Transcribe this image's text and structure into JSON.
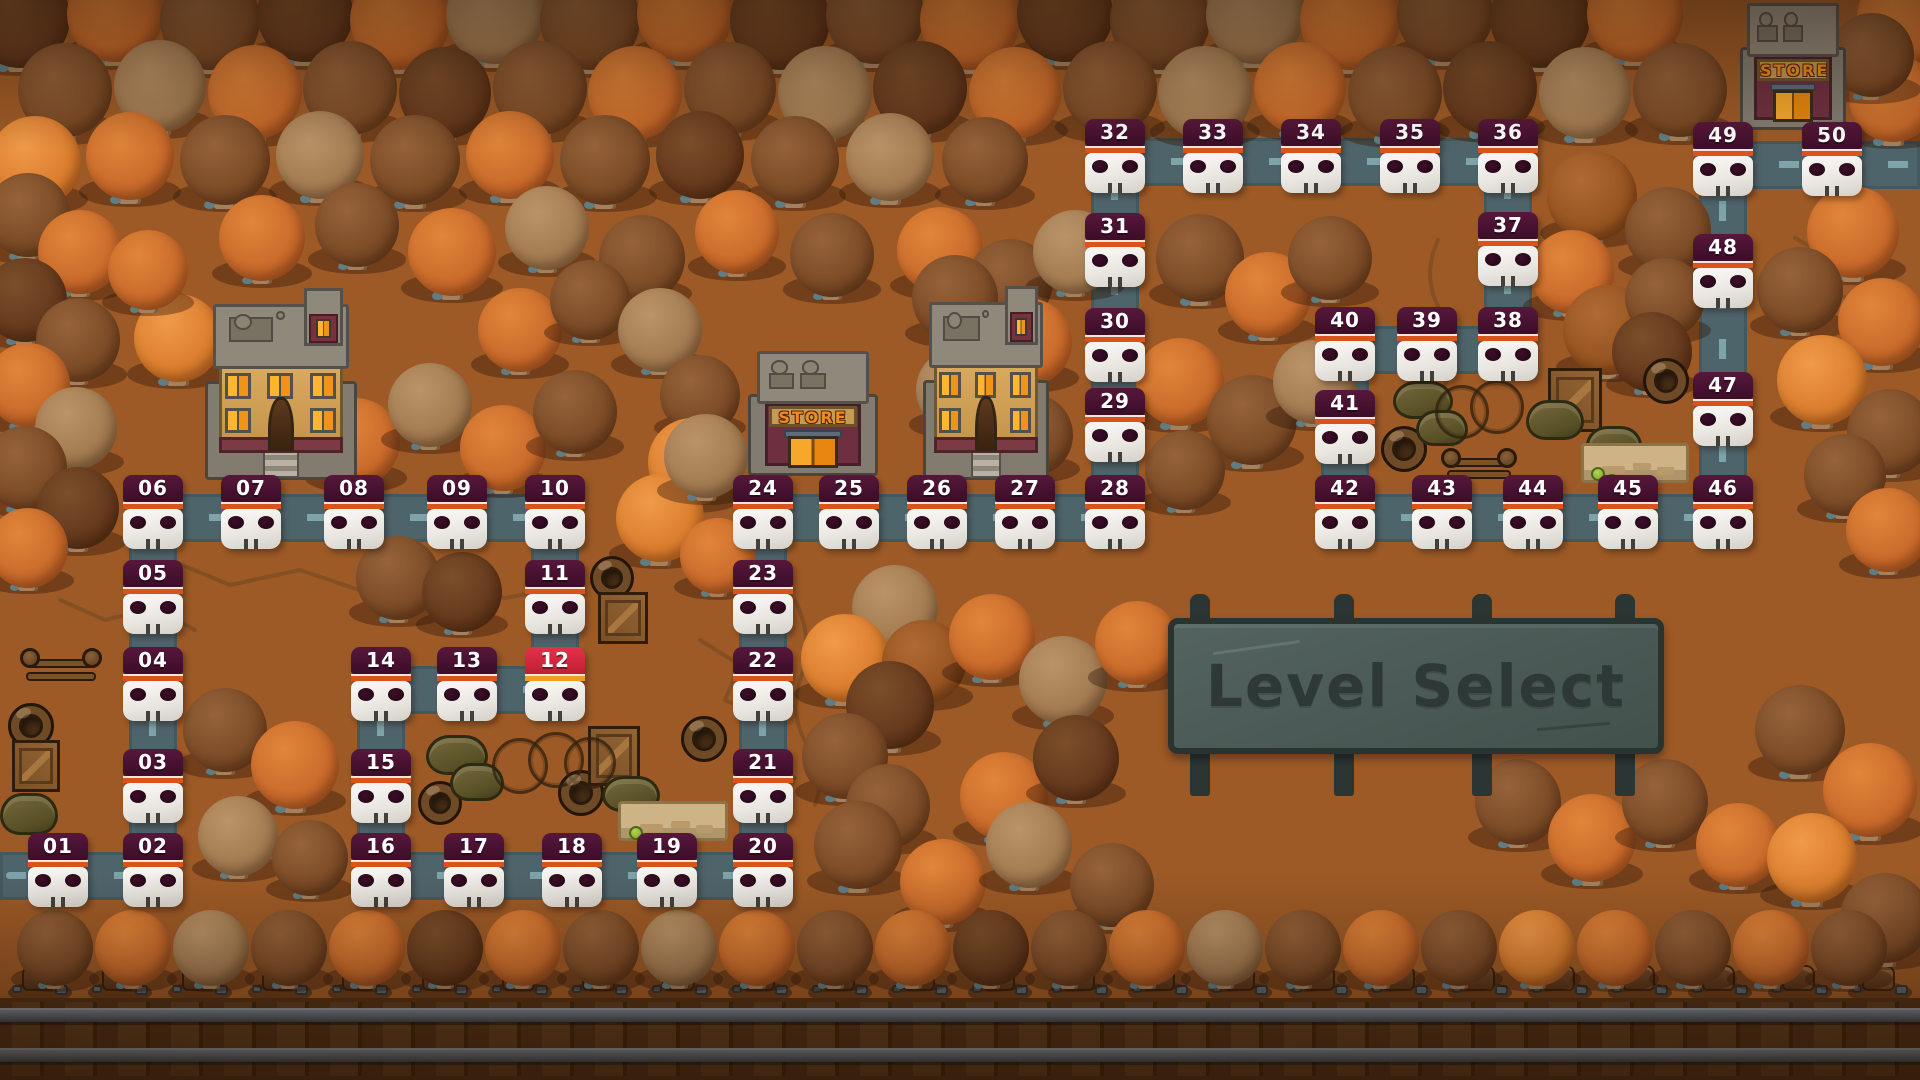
{
  "title": "Level Select",
  "sign": {
    "label": "Level Select"
  },
  "current_level": "12",
  "colors": {
    "ground": "#a05c27",
    "road": "#4e646b",
    "road_dash": "#86aeb3",
    "banner": "#451130",
    "banner_current": "#d32a3c",
    "stripe": "#d9531d",
    "stripe_current": "#eca01d",
    "skull": "#ece9e4",
    "sign_board": "#4a5955",
    "sign_text": "#2e3836"
  },
  "levels": [
    {
      "id": "01",
      "x": 58,
      "y": 876
    },
    {
      "id": "02",
      "x": 153,
      "y": 876
    },
    {
      "id": "03",
      "x": 153,
      "y": 792
    },
    {
      "id": "04",
      "x": 153,
      "y": 690
    },
    {
      "id": "05",
      "x": 153,
      "y": 603
    },
    {
      "id": "06",
      "x": 153,
      "y": 518
    },
    {
      "id": "07",
      "x": 251,
      "y": 518
    },
    {
      "id": "08",
      "x": 354,
      "y": 518
    },
    {
      "id": "09",
      "x": 457,
      "y": 518
    },
    {
      "id": "10",
      "x": 555,
      "y": 518
    },
    {
      "id": "11",
      "x": 555,
      "y": 603
    },
    {
      "id": "12",
      "x": 555,
      "y": 690,
      "state": "current"
    },
    {
      "id": "13",
      "x": 467,
      "y": 690
    },
    {
      "id": "14",
      "x": 381,
      "y": 690
    },
    {
      "id": "15",
      "x": 381,
      "y": 792
    },
    {
      "id": "16",
      "x": 381,
      "y": 876
    },
    {
      "id": "17",
      "x": 474,
      "y": 876
    },
    {
      "id": "18",
      "x": 572,
      "y": 876
    },
    {
      "id": "19",
      "x": 667,
      "y": 876
    },
    {
      "id": "20",
      "x": 763,
      "y": 876
    },
    {
      "id": "21",
      "x": 763,
      "y": 792
    },
    {
      "id": "22",
      "x": 763,
      "y": 690
    },
    {
      "id": "23",
      "x": 763,
      "y": 603
    },
    {
      "id": "24",
      "x": 763,
      "y": 518
    },
    {
      "id": "25",
      "x": 849,
      "y": 518
    },
    {
      "id": "26",
      "x": 937,
      "y": 518
    },
    {
      "id": "27",
      "x": 1025,
      "y": 518
    },
    {
      "id": "28",
      "x": 1115,
      "y": 518
    },
    {
      "id": "29",
      "x": 1115,
      "y": 431
    },
    {
      "id": "30",
      "x": 1115,
      "y": 351
    },
    {
      "id": "31",
      "x": 1115,
      "y": 256
    },
    {
      "id": "32",
      "x": 1115,
      "y": 162
    },
    {
      "id": "33",
      "x": 1213,
      "y": 162
    },
    {
      "id": "34",
      "x": 1311,
      "y": 162
    },
    {
      "id": "35",
      "x": 1410,
      "y": 162
    },
    {
      "id": "36",
      "x": 1508,
      "y": 162
    },
    {
      "id": "37",
      "x": 1508,
      "y": 255
    },
    {
      "id": "38",
      "x": 1508,
      "y": 350
    },
    {
      "id": "39",
      "x": 1427,
      "y": 350
    },
    {
      "id": "40",
      "x": 1345,
      "y": 350
    },
    {
      "id": "41",
      "x": 1345,
      "y": 433
    },
    {
      "id": "42",
      "x": 1345,
      "y": 518
    },
    {
      "id": "43",
      "x": 1442,
      "y": 518
    },
    {
      "id": "44",
      "x": 1533,
      "y": 518
    },
    {
      "id": "45",
      "x": 1628,
      "y": 518
    },
    {
      "id": "46",
      "x": 1723,
      "y": 518
    },
    {
      "id": "47",
      "x": 1723,
      "y": 415
    },
    {
      "id": "48",
      "x": 1723,
      "y": 277
    },
    {
      "id": "49",
      "x": 1723,
      "y": 165
    },
    {
      "id": "50",
      "x": 1832,
      "y": 165
    }
  ],
  "path": {
    "road_width": 48,
    "extra_segments": [
      [
        0,
        876,
        58,
        876
      ],
      [
        1832,
        165,
        1920,
        165
      ]
    ]
  },
  "buildings": [
    {
      "type": "house",
      "x": 205,
      "y": 288,
      "w": 152,
      "h": 194
    },
    {
      "type": "store",
      "label": "STORE",
      "x": 748,
      "y": 348,
      "w": 130,
      "h": 128
    },
    {
      "type": "house",
      "x": 923,
      "y": 286,
      "w": 126,
      "h": 196
    },
    {
      "type": "store",
      "label": "STORE",
      "x": 1740,
      "y": 0,
      "w": 106,
      "h": 130
    }
  ],
  "decorations": {
    "fences": [
      {
        "x": 20,
        "y": 648,
        "w": 82,
        "h": 38
      },
      {
        "x": 1441,
        "y": 448,
        "w": 76,
        "h": 36
      }
    ],
    "barrels": [
      [
        8,
        703,
        46
      ],
      [
        418,
        781,
        44
      ],
      [
        558,
        770,
        46
      ],
      [
        681,
        716,
        46
      ],
      [
        1381,
        426,
        46
      ],
      [
        1643,
        358,
        46
      ],
      [
        590,
        556,
        44
      ]
    ],
    "crates": [
      [
        12,
        740,
        48,
        52
      ],
      [
        598,
        592,
        50,
        52
      ],
      [
        588,
        726,
        52,
        60
      ],
      [
        1548,
        368,
        54,
        64
      ]
    ],
    "sandbags": [
      [
        0,
        793,
        58,
        42
      ],
      [
        426,
        735,
        62,
        40
      ],
      [
        450,
        763,
        54,
        38
      ],
      [
        602,
        776,
        58,
        36
      ],
      [
        1393,
        381,
        60,
        38
      ],
      [
        1416,
        410,
        52,
        36
      ],
      [
        1526,
        400,
        58,
        40
      ],
      [
        1586,
        426,
        56,
        36
      ]
    ],
    "wires": [
      [
        520,
        766,
        28
      ],
      [
        556,
        760,
        28
      ],
      [
        590,
        763,
        26
      ],
      [
        1462,
        412,
        27
      ],
      [
        1497,
        407,
        27
      ]
    ],
    "planks": [
      [
        618,
        801,
        110,
        40
      ],
      [
        1581,
        443,
        108,
        40
      ]
    ],
    "plants": [
      [
        636,
        833
      ],
      [
        652,
        840
      ],
      [
        1598,
        474
      ],
      [
        1612,
        481
      ]
    ]
  },
  "sign_layout": {
    "board": [
      1168,
      618,
      496,
      136
    ],
    "posts_x": [
      1190,
      1334,
      1472,
      1615
    ],
    "post_top_y": 594,
    "post_top_h": 34,
    "post_bot_y": 748,
    "post_bot_h": 48
  },
  "stumps": {
    "y": 985,
    "xs": [
      40,
      120,
      200,
      280,
      360,
      440,
      520,
      600,
      680,
      760,
      840,
      920,
      1000,
      1080,
      1160,
      1240,
      1320,
      1400,
      1480,
      1560,
      1640,
      1720,
      1800,
      1880
    ]
  },
  "trees": [
    [
      20,
      18,
      50,
      3
    ],
    [
      115,
      14,
      48,
      0
    ],
    [
      210,
      20,
      50,
      1
    ],
    [
      305,
      14,
      48,
      3
    ],
    [
      400,
      20,
      50,
      0
    ],
    [
      495,
      15,
      49,
      2
    ],
    [
      590,
      20,
      50,
      1
    ],
    [
      685,
      14,
      48,
      0
    ],
    [
      780,
      20,
      50,
      3
    ],
    [
      875,
      15,
      49,
      1
    ],
    [
      970,
      20,
      50,
      0
    ],
    [
      1065,
      14,
      48,
      3
    ],
    [
      1160,
      20,
      50,
      1
    ],
    [
      1255,
      15,
      49,
      2
    ],
    [
      1350,
      20,
      50,
      0
    ],
    [
      1445,
      14,
      48,
      1
    ],
    [
      1540,
      18,
      50,
      3
    ],
    [
      1635,
      14,
      48,
      0
    ],
    [
      1905,
      18,
      48,
      0
    ],
    [
      65,
      90,
      47,
      1
    ],
    [
      160,
      86,
      46,
      2
    ],
    [
      255,
      92,
      47,
      0
    ],
    [
      350,
      88,
      47,
      1
    ],
    [
      445,
      93,
      46,
      3
    ],
    [
      540,
      88,
      47,
      1
    ],
    [
      635,
      93,
      47,
      0
    ],
    [
      730,
      88,
      46,
      1
    ],
    [
      825,
      93,
      47,
      2
    ],
    [
      920,
      88,
      47,
      3
    ],
    [
      1015,
      93,
      46,
      0
    ],
    [
      1110,
      88,
      47,
      1
    ],
    [
      1205,
      93,
      47,
      2
    ],
    [
      1300,
      88,
      46,
      0
    ],
    [
      1395,
      93,
      47,
      1
    ],
    [
      1490,
      88,
      47,
      3
    ],
    [
      1585,
      93,
      46,
      2
    ],
    [
      1680,
      90,
      47,
      1
    ],
    [
      1893,
      98,
      44,
      0
    ],
    [
      1872,
      55,
      42,
      1
    ],
    [
      35,
      162,
      46,
      5
    ],
    [
      130,
      156,
      44,
      0
    ],
    [
      225,
      160,
      45,
      1
    ],
    [
      320,
      155,
      44,
      2
    ],
    [
      415,
      160,
      45,
      1
    ],
    [
      510,
      155,
      44,
      0
    ],
    [
      605,
      160,
      45,
      1
    ],
    [
      700,
      155,
      44,
      3
    ],
    [
      795,
      160,
      44,
      1
    ],
    [
      890,
      157,
      44,
      2
    ],
    [
      985,
      160,
      43,
      1
    ],
    [
      28,
      215,
      42,
      1
    ],
    [
      80,
      252,
      42,
      0
    ],
    [
      25,
      300,
      42,
      3
    ],
    [
      78,
      340,
      42,
      1
    ],
    [
      28,
      385,
      42,
      0
    ],
    [
      76,
      428,
      41,
      2
    ],
    [
      25,
      468,
      42,
      1
    ],
    [
      78,
      508,
      41,
      3
    ],
    [
      28,
      548,
      40,
      0
    ],
    [
      262,
      238,
      43,
      0
    ],
    [
      357,
      225,
      42,
      1
    ],
    [
      452,
      252,
      44,
      0
    ],
    [
      547,
      228,
      42,
      2
    ],
    [
      642,
      258,
      43,
      1
    ],
    [
      737,
      232,
      42,
      0
    ],
    [
      832,
      255,
      42,
      1
    ],
    [
      940,
      250,
      43,
      0
    ],
    [
      1010,
      282,
      43,
      1
    ],
    [
      1075,
      252,
      42,
      2
    ],
    [
      178,
      338,
      44,
      5
    ],
    [
      148,
      270,
      40,
      0
    ],
    [
      283,
      405,
      42,
      1
    ],
    [
      356,
      442,
      44,
      0
    ],
    [
      430,
      405,
      42,
      2
    ],
    [
      503,
      448,
      43,
      0
    ],
    [
      575,
      412,
      42,
      1
    ],
    [
      520,
      330,
      42,
      0
    ],
    [
      590,
      300,
      40,
      1
    ],
    [
      660,
      330,
      42,
      2
    ],
    [
      700,
      395,
      40,
      1
    ],
    [
      692,
      462,
      44,
      5
    ],
    [
      660,
      518,
      44,
      5
    ],
    [
      706,
      456,
      42,
      2
    ],
    [
      718,
      556,
      38,
      0
    ],
    [
      398,
      578,
      42,
      1
    ],
    [
      462,
      592,
      40,
      3
    ],
    [
      225,
      730,
      42,
      1
    ],
    [
      295,
      765,
      44,
      0
    ],
    [
      238,
      836,
      40,
      2
    ],
    [
      310,
      858,
      38,
      1
    ],
    [
      955,
      298,
      43,
      1
    ],
    [
      1028,
      342,
      44,
      0
    ],
    [
      958,
      390,
      42,
      2
    ],
    [
      1032,
      435,
      41,
      1
    ],
    [
      1200,
      258,
      44,
      1
    ],
    [
      1268,
      295,
      43,
      0
    ],
    [
      1330,
      258,
      42,
      1
    ],
    [
      1180,
      382,
      44,
      0
    ],
    [
      1252,
      420,
      45,
      1
    ],
    [
      1315,
      382,
      42,
      2
    ],
    [
      1185,
      470,
      40,
      1
    ],
    [
      1592,
      196,
      45,
      4
    ],
    [
      1668,
      230,
      43,
      1
    ],
    [
      1572,
      272,
      42,
      0
    ],
    [
      1608,
      330,
      45,
      4
    ],
    [
      1665,
      298,
      40,
      1
    ],
    [
      1652,
      352,
      40,
      3
    ],
    [
      1853,
      232,
      46,
      0
    ],
    [
      1800,
      290,
      43,
      1
    ],
    [
      1882,
      322,
      44,
      0
    ],
    [
      1822,
      380,
      45,
      5
    ],
    [
      1890,
      432,
      43,
      1
    ],
    [
      1845,
      475,
      41,
      1
    ],
    [
      1888,
      530,
      42,
      0
    ],
    [
      895,
      608,
      43,
      2
    ],
    [
      845,
      658,
      44,
      5
    ],
    [
      924,
      662,
      42,
      4
    ],
    [
      890,
      705,
      44,
      3
    ],
    [
      845,
      756,
      43,
      1
    ],
    [
      888,
      806,
      42,
      1
    ],
    [
      992,
      637,
      43,
      0
    ],
    [
      1063,
      680,
      44,
      2
    ],
    [
      1137,
      643,
      42,
      0
    ],
    [
      1004,
      796,
      44,
      0
    ],
    [
      1076,
      758,
      43,
      3
    ],
    [
      858,
      845,
      44,
      1
    ],
    [
      943,
      882,
      43,
      0
    ],
    [
      1029,
      845,
      43,
      2
    ],
    [
      1112,
      885,
      42,
      1
    ],
    [
      1518,
      802,
      43,
      1
    ],
    [
      1592,
      838,
      44,
      0
    ],
    [
      1665,
      802,
      43,
      1
    ],
    [
      1738,
      845,
      42,
      0
    ],
    [
      1800,
      730,
      45,
      1
    ],
    [
      1870,
      790,
      47,
      0
    ],
    [
      1812,
      858,
      45,
      5
    ],
    [
      1885,
      918,
      45,
      1
    ],
    [
      55,
      948,
      38,
      1
    ],
    [
      133,
      948,
      38,
      0
    ],
    [
      211,
      948,
      38,
      2
    ],
    [
      289,
      948,
      38,
      1
    ],
    [
      367,
      948,
      38,
      0
    ],
    [
      445,
      948,
      38,
      3
    ],
    [
      523,
      948,
      38,
      0
    ],
    [
      601,
      948,
      38,
      1
    ],
    [
      679,
      948,
      38,
      2
    ],
    [
      757,
      948,
      38,
      0
    ],
    [
      835,
      948,
      38,
      1
    ],
    [
      913,
      948,
      38,
      0
    ],
    [
      991,
      948,
      38,
      3
    ],
    [
      1069,
      948,
      38,
      1
    ],
    [
      1147,
      948,
      38,
      0
    ],
    [
      1225,
      948,
      38,
      2
    ],
    [
      1303,
      948,
      38,
      1
    ],
    [
      1381,
      948,
      38,
      0
    ],
    [
      1459,
      948,
      38,
      1
    ],
    [
      1537,
      948,
      38,
      5
    ],
    [
      1615,
      948,
      38,
      0
    ],
    [
      1693,
      948,
      38,
      1
    ],
    [
      1771,
      948,
      38,
      0
    ],
    [
      1849,
      948,
      38,
      1
    ]
  ]
}
